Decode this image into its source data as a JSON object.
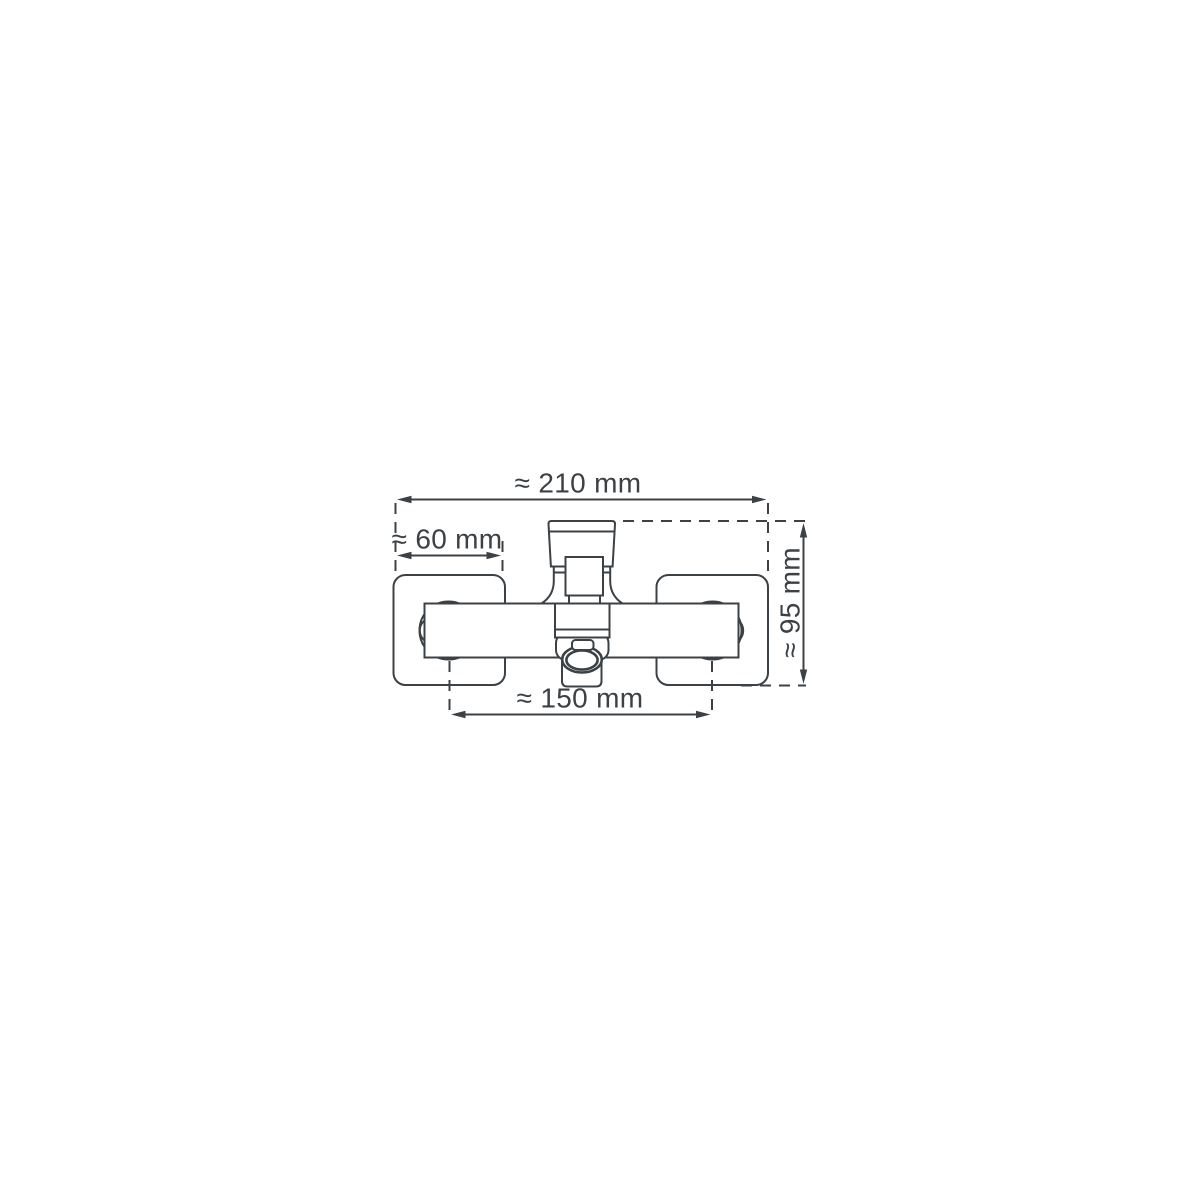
{
  "diagram": {
    "background_color": "#ffffff",
    "line_color": "#3c4146",
    "unit": "mm",
    "approx_symbol": "≈",
    "dimension_labels": {
      "overall_width": "≈ 210 mm",
      "wall_plate_width": "≈ 60 mm",
      "body_height": "≈ 95 mm",
      "connection_centers": "≈ 150 mm"
    },
    "dimension_values_mm": {
      "overall_width": 210,
      "wall_plate_width": 60,
      "body_height": 95,
      "connection_centers": 150
    }
  }
}
